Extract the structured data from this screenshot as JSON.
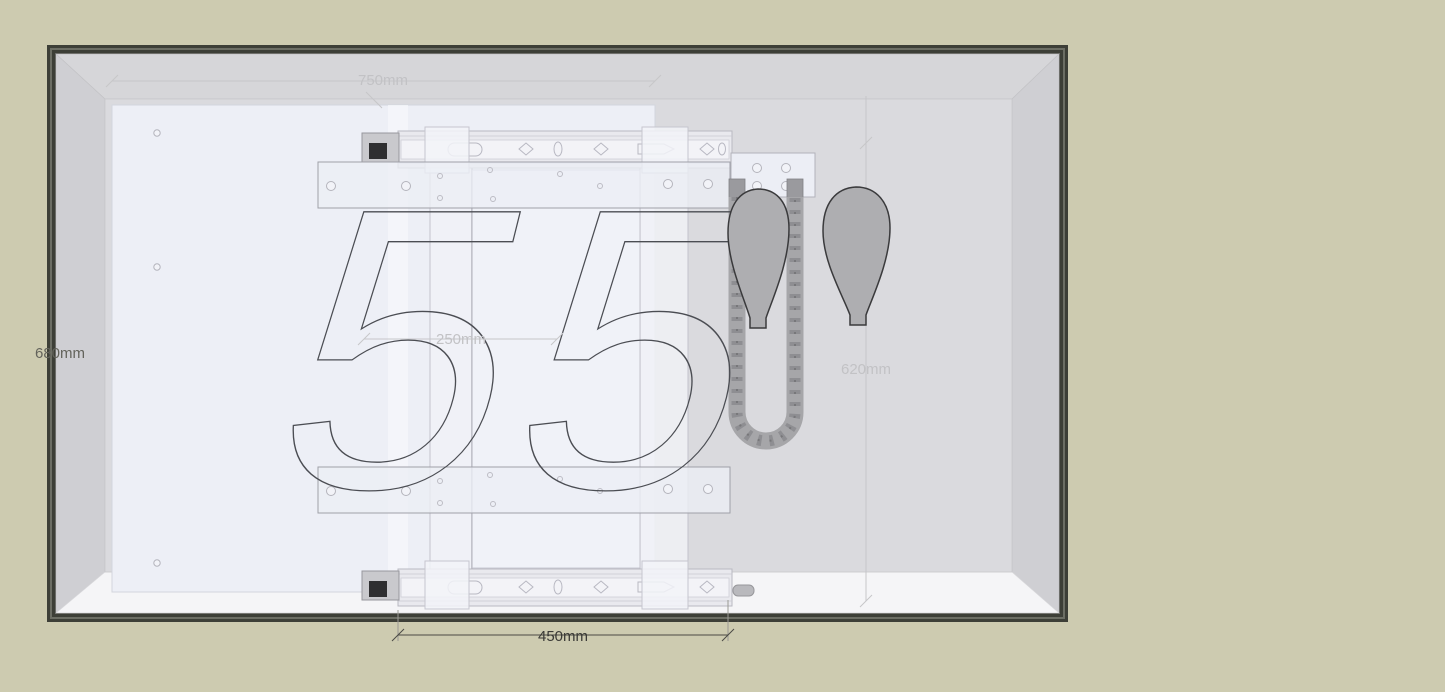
{
  "scene": {
    "description": "CAD perspective view of a 55-inch display lift mechanism inside a dark-framed enclosure",
    "size_label": "55"
  },
  "dimensions": {
    "width_top": "750mm",
    "height_left": "680mm",
    "carriage_offset": "250mm",
    "travel_right": "620mm",
    "rail_span_bottom": "450mm"
  },
  "colors": {
    "canvas_background": "#cdcbb0",
    "frame": "#3d3f37",
    "interior_wall": "#d3d3d6",
    "back_panel": "#dadade",
    "floor": "#f5f5f7",
    "tv_back_panel": "#edeff6",
    "dim_label_light": "#c2c2c5",
    "dim_label_dark": "#3a3a36",
    "outline_55": "#4b4d53",
    "inch_mark_fill": "#aeaeb1",
    "chain": "#a6a6a9"
  }
}
